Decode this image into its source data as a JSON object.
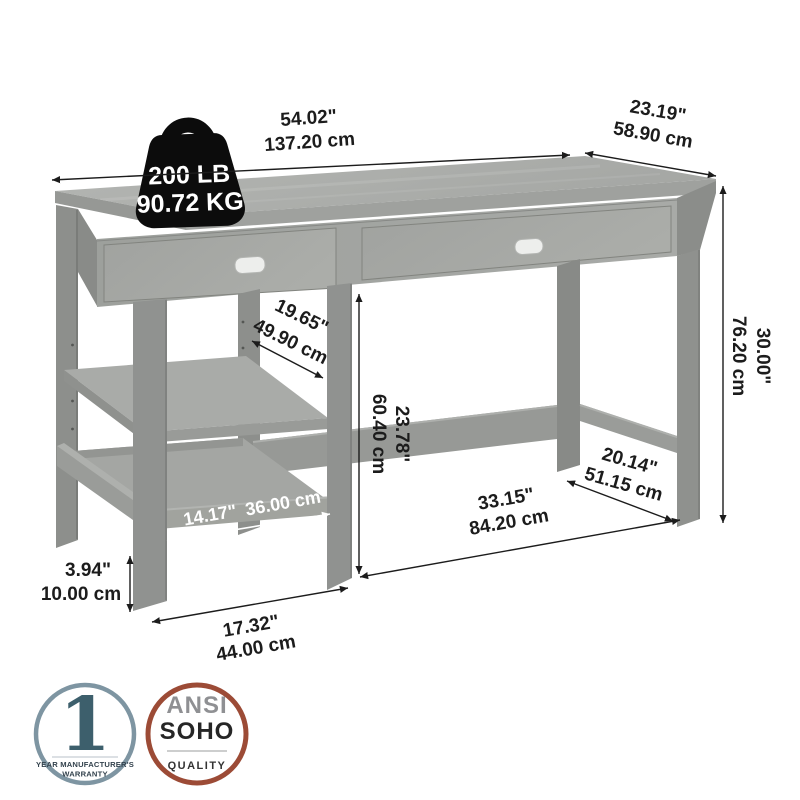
{
  "diagram": {
    "title": "desk-dimension-diagram",
    "weight_capacity": {
      "pounds": "200 LB",
      "kilograms": "90.72 KG"
    },
    "dimensions": {
      "width": {
        "inches": "54.02\"",
        "centimeters": "137.20 cm"
      },
      "depth": {
        "inches": "23.19\"",
        "centimeters": "58.90 cm"
      },
      "height": {
        "inches": "30.00\"",
        "centimeters": "76.20 cm"
      },
      "open_shelf_depth": {
        "inches": "19.65\"",
        "centimeters": "49.90 cm"
      },
      "desktop_to_stretcher": {
        "inches": "23.78\"",
        "centimeters": "60.40 cm"
      },
      "shelf_width": {
        "inches": "14.17\"",
        "centimeters": "36.00 cm"
      },
      "kneehole_width": {
        "inches": "33.15\"",
        "centimeters": "84.20 cm"
      },
      "side_stretcher": {
        "inches": "20.14\"",
        "centimeters": "51.15 cm"
      },
      "foot_height": {
        "inches": "3.94\"",
        "centimeters": "10.00 cm"
      },
      "pedestal_width": {
        "inches": "17.32\"",
        "centimeters": "44.00 cm"
      }
    },
    "badges": {
      "warranty": {
        "value": "1",
        "caption_line1": "YEAR MANUFACTURER'S",
        "caption_line2": "WARRANTY"
      },
      "quality": {
        "line1": "ANSI",
        "line2": "SOHO",
        "line3": "QUALITY"
      }
    },
    "colors": {
      "ink": "#1c1c1c",
      "desk_top": "#adafac",
      "desk_front": "#a3a5a2",
      "desk_leg": "#8e908d",
      "weight_badge": "#0c0c0c",
      "warranty_ring": "#7e95a2",
      "warranty_number": "#3d5f6c",
      "quality_ring": "#9c4b36",
      "quality_gray": "#8f9093",
      "white_label": "#ffffff"
    }
  }
}
